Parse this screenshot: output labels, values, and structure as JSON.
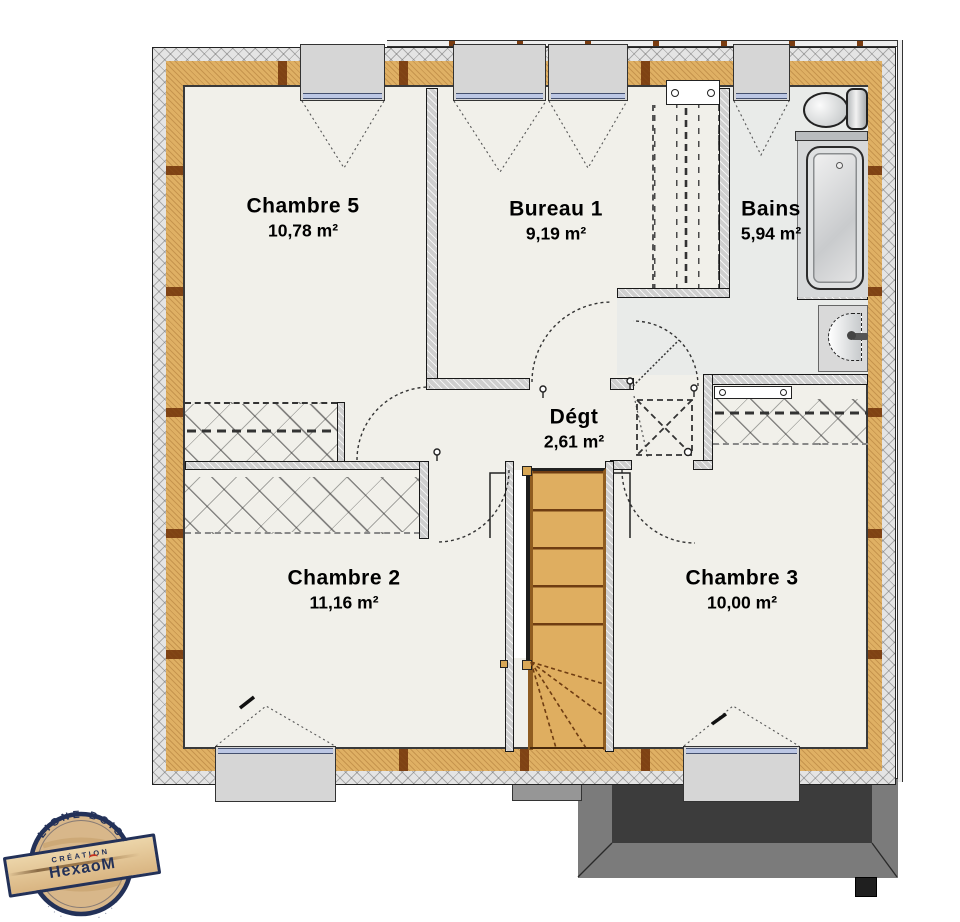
{
  "rooms": [
    {
      "name": "Chambre 5",
      "area": "10,78 m²"
    },
    {
      "name": "Bureau 1",
      "area": "9,19 m²"
    },
    {
      "name": "Bains",
      "area": "5,94 m²"
    },
    {
      "name": "Dégt",
      "area": "2,61 m²"
    },
    {
      "name": "Chambre 2",
      "area": "11,16 m²"
    },
    {
      "name": "Chambre 3",
      "area": "10,00 m²"
    }
  ],
  "logo": {
    "arc_top": "LIGNE BOIS",
    "arc_bottom": "· · · · · · · · · · · ·",
    "line_small": "CRÉATION",
    "brand_prefix": "Hexa",
    "brand_o": "o",
    "brand_suffix": "M"
  },
  "icons": {
    "toilet": "toilet-icon",
    "bathtub": "bathtub-icon",
    "washbasin": "washbasin-icon",
    "staircase": "staircase",
    "roof_hatch": "roof-hatch-x",
    "radiator": "radiator"
  },
  "colors": {
    "wall_hatch": "#e4e4e4",
    "insulation": "#dfb064",
    "stud": "#7a3c10",
    "floor": "#f1f0ea",
    "stairs": "#dfae60",
    "glazing": "#bcc7e4",
    "roof_mid": "#7b7b7b",
    "roof_dark": "#3c3c3c",
    "logo_navy": "#233158",
    "logo_red": "#c5311f",
    "logo_wood": "#d8b78a"
  }
}
